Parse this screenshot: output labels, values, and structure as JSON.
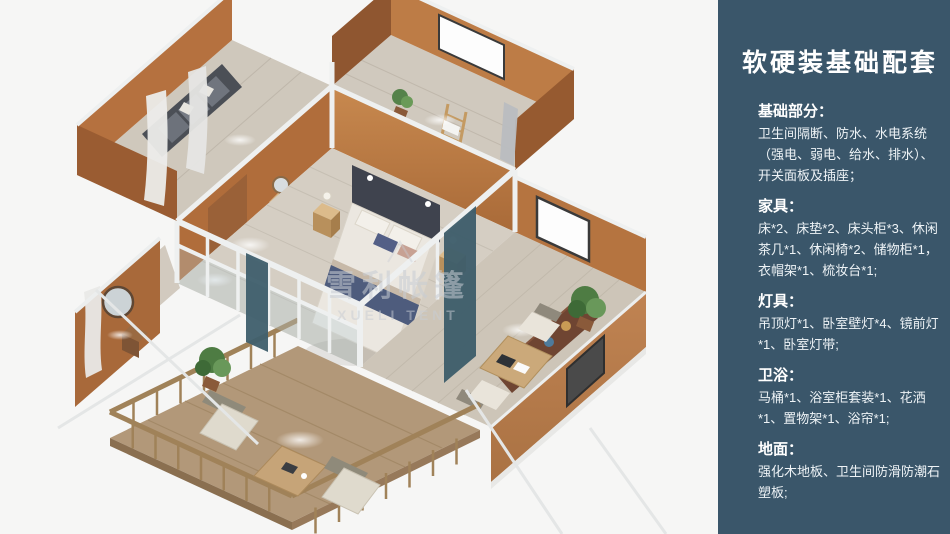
{
  "page": {
    "width_px": 950,
    "height_px": 534,
    "canvas_background": "#f6f6f5"
  },
  "sidebar": {
    "background_color": "#3a566a",
    "text_color": "#ffffff",
    "title": "软硬装基础配套",
    "sections": [
      {
        "heading": "基础部分：",
        "body": "卫生间隔断、防水、水电系统（强电、弱电、给水、排水）、开关面板及插座；"
      },
      {
        "heading": "家具：",
        "body": "床*2、床垫*2、床头柜*3、休闲茶几*1、休闲椅*2、储物柜*1，衣帽架*1、梳妆台*1;"
      },
      {
        "heading": "灯具：",
        "body": "吊顶灯*1、卧室壁灯*4、镜前灯*1、卧室灯带;"
      },
      {
        "heading": "卫浴：",
        "body": "马桶*1、浴室柜套装*1、花洒*1、置物架*1、浴帘*1;"
      },
      {
        "heading": "地面：",
        "body": "强化木地板、卫生间防滑防潮石塑板;"
      }
    ]
  },
  "render": {
    "watermark_cn": "雪利帐篷",
    "watermark_en": "XUELI TENT",
    "colors": {
      "wall_tan": "#b5713f",
      "wall_lit": "#c58a52",
      "floor_wood": "#d5cec3",
      "deck_wood": "#b29879",
      "frame_white": "#eef0f0",
      "bedding_navy": "#4e5c7d",
      "plant_green": "#4e7c43",
      "curtain_teal": "#3e5e6b"
    }
  }
}
